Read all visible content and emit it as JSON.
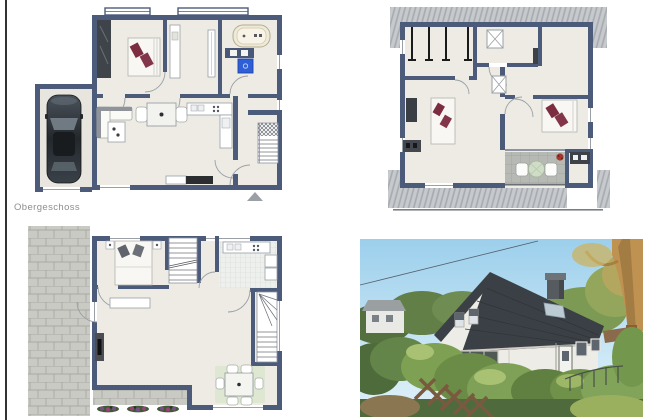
{
  "labels": {
    "upper_floor": "Obergeschoss"
  },
  "panels": [
    {
      "id": "floorplan-ground",
      "kind": "floor-plan"
    },
    {
      "id": "floorplan-attic",
      "kind": "floor-plan"
    },
    {
      "id": "floorplan-upper",
      "kind": "floor-plan",
      "label": "Obergeschoss"
    },
    {
      "id": "house-photo",
      "kind": "photo"
    }
  ],
  "palette": {
    "wall": "#4d5b7a",
    "floor": "#edebe3",
    "roof_overhang_hatch": "#c7cacd",
    "terrace_paving": "#cacac5",
    "washing_machine_blue": "#2f5fd6",
    "pillow_red": "#7c2d3f",
    "rug_green": "#dde7d2",
    "label_gray": "#8e8e8e",
    "photo_sky": "#a8d4ec",
    "photo_roof": "#3a4045",
    "photo_wall": "#edece6"
  }
}
